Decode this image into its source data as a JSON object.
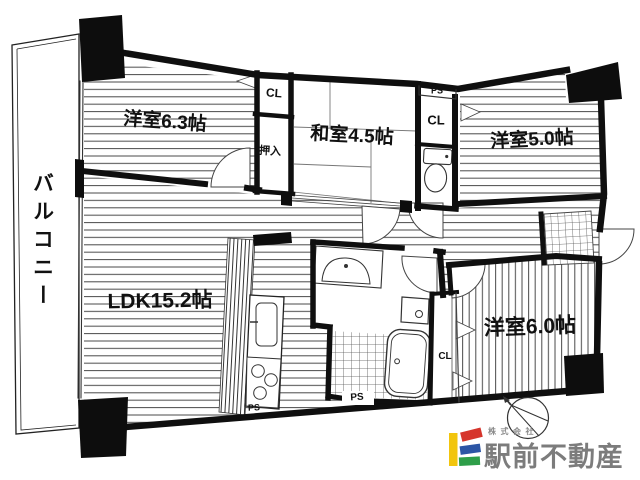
{
  "floorplan": {
    "balcony_label": "バルコニー",
    "rooms": {
      "western1": {
        "label": "洋室6.3帖"
      },
      "japanese": {
        "label": "和室4.5帖"
      },
      "western2": {
        "label": "洋室5.0帖"
      },
      "ldk": {
        "label": "LDK15.2帖"
      },
      "western3": {
        "label": "洋室6.0帖"
      }
    },
    "storage": {
      "cl_top": "CL",
      "cl_right": "CL",
      "cl_lower": "CL",
      "oshiire": "押入"
    },
    "shafts": {
      "ps_top": "PS",
      "ps_bath": "PS",
      "ps_kitchen": "PS"
    }
  },
  "logo": {
    "company_prefix": "株式会社",
    "company_name": "駅前不動産",
    "colors": {
      "yellow": "#F2C50D",
      "red": "#D6352C",
      "blue": "#2C55A5",
      "green": "#2E9E49"
    }
  }
}
